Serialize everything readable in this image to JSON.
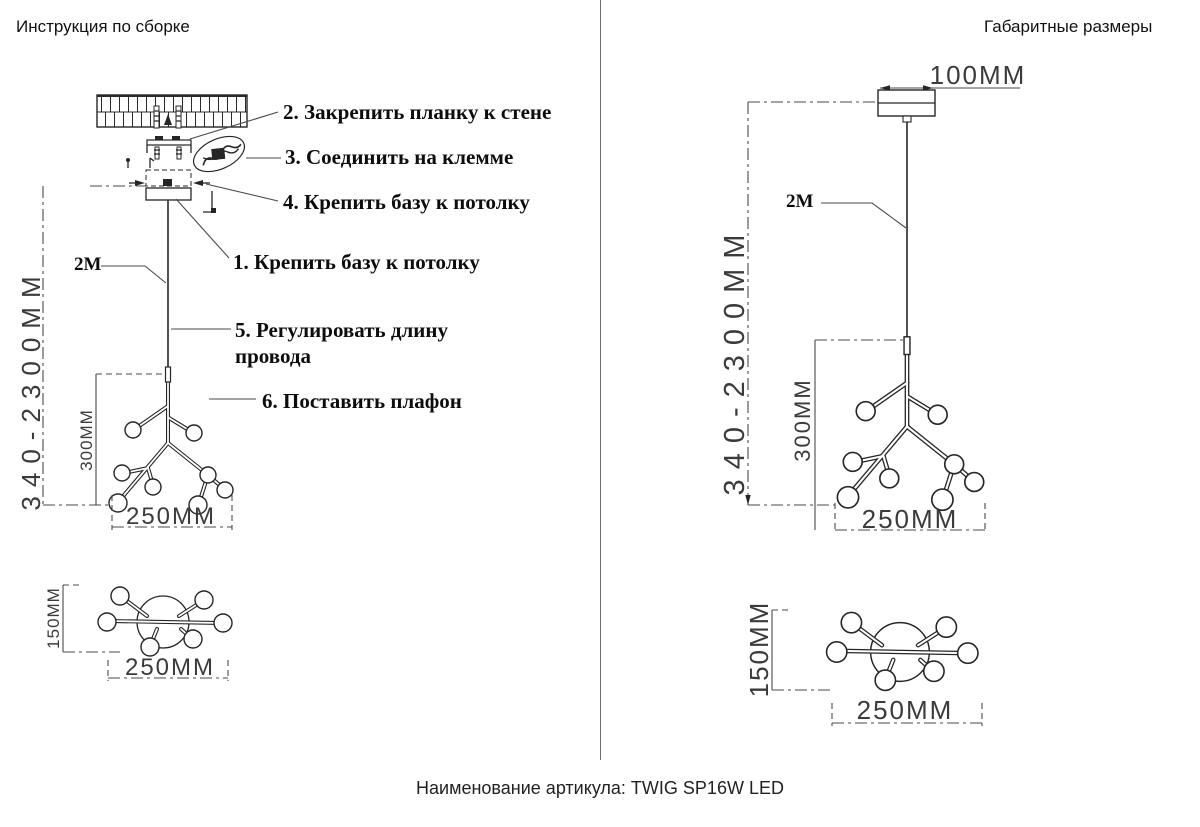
{
  "page": {
    "left_title": "Инструкция по сборке",
    "right_title": "Габаритные размеры",
    "article_caption": "Наименование артикула: TWIG SP16W LED"
  },
  "assembly": {
    "steps": {
      "s1": "1. Крепить базу к потолку",
      "s2": "2. Закрепить планку к стене",
      "s3": "3. Соединить на клемме",
      "s4": "4. Крепить базу к потолку",
      "s5": "5. Регулировать длину провода",
      "s6": "6. Поставить плафон"
    },
    "dims": {
      "cord_length": "2M",
      "height_range": "340-2300MM",
      "body_height": "300MM",
      "body_width": "250MM",
      "top_view_depth": "150MM",
      "top_view_width": "250MM"
    }
  },
  "overall": {
    "dims": {
      "canopy_width": "100MM",
      "cord_length": "2M",
      "height_range": "340-2300MM",
      "body_height": "300MM",
      "body_width": "250MM",
      "top_view_depth": "150MM",
      "top_view_width": "250MM"
    }
  }
}
